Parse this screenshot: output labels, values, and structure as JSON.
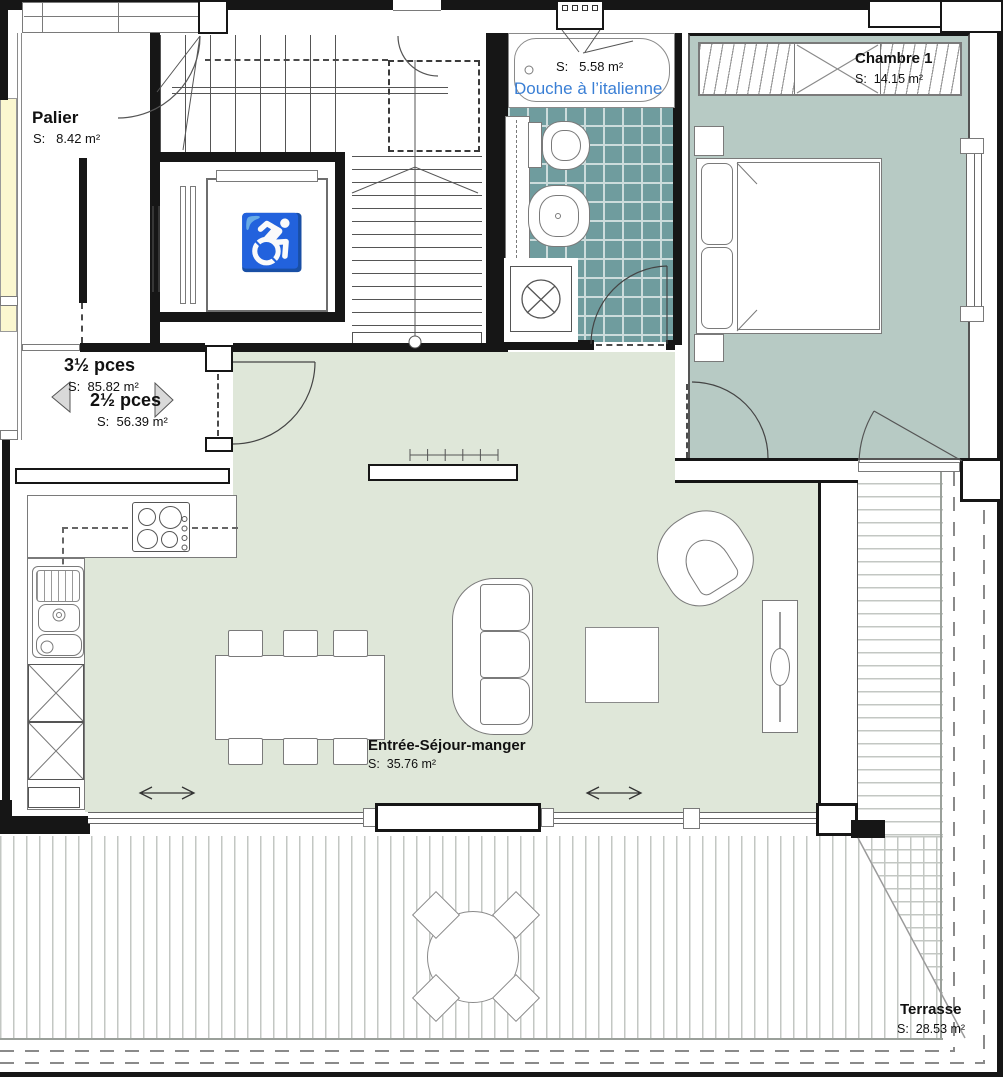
{
  "colors": {
    "wall": "#161616",
    "furniture_outline": "#7a7a7a",
    "living_floor": "#dfe7d9",
    "bedroom_floor": "#b7cac4",
    "bath_tile": "#6f9c9e",
    "bath_grout": "#ccdcdc",
    "neighbor_room": "#fbf7d0",
    "deck_line": "#c3c7c3",
    "shower_label_blue": "#3a7fd5"
  },
  "rooms": {
    "palier": {
      "name": "Palier",
      "area": "S:   8.42 m²"
    },
    "shower": {
      "name": "Douche à l’italienne",
      "area": "S:   5.58 m²"
    },
    "bedroom": {
      "name": "Chambre 1",
      "area": "S:  14.15 m²"
    },
    "living": {
      "name": "Entrée-Séjour-manger",
      "area": "S:  35.76 m²"
    },
    "terrace": {
      "name": "Terrasse",
      "area": "S:  28.53 m²"
    }
  },
  "apartments": {
    "apt_3_5": {
      "name": "3½ pces",
      "area": "S:  85.82 m²"
    },
    "apt_2_5": {
      "name": "2½ pces",
      "area": "S:  56.39 m²"
    }
  },
  "icons": {
    "wheelchair": "♿"
  }
}
